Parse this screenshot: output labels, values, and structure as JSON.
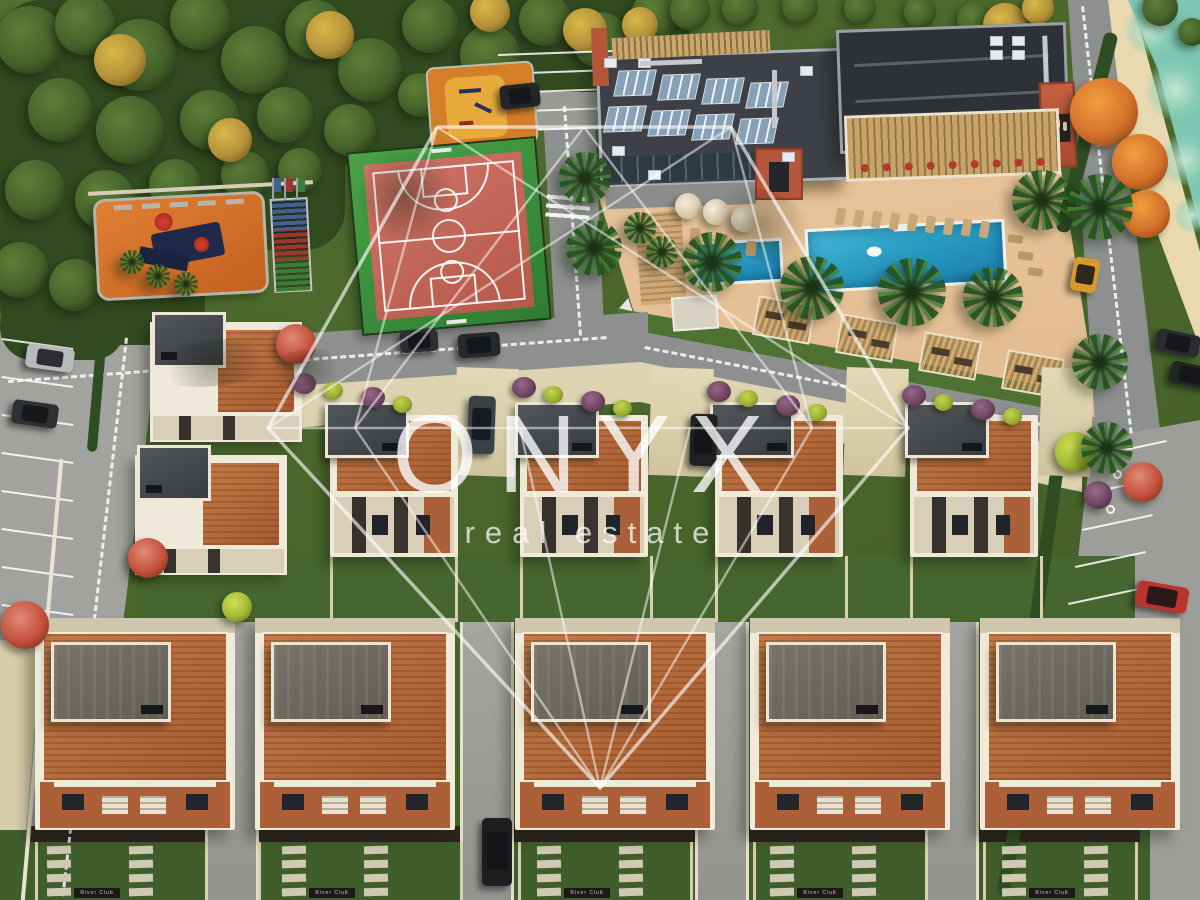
{
  "meta": {
    "title": "Aerial 3D render of ONYX real estate residential villa complex",
    "width": 1200,
    "height": 900
  },
  "watermark": {
    "brand": "ONYX",
    "tagline": "real estate",
    "color": "#ffffff"
  },
  "signs": {
    "villa_plaque": "River Club"
  },
  "palette": {
    "road": "#8e908f",
    "parking": "#a2a29f",
    "deck": "#e4bd92",
    "lawn": "#4e7231",
    "grass": "#4a662c",
    "grassDark": "#3c5a2a",
    "forest": "#314a20",
    "river": "#7cc6b2",
    "cream": "#d9cfad",
    "wallWhite": "#efe9da",
    "brick": "#b0673a",
    "brickLower": "#b86c3c",
    "roofDark": "#3d4046",
    "roofDarker": "#2e3136",
    "roofGrey": "#6e6a60",
    "courtRed": "#c4685c",
    "courtGreen": "#3e9a40",
    "playOrange": "#d06f28",
    "fitOrange": "#d57e28",
    "fitYellow": "#e8a93c",
    "pool": "#2b9fc4",
    "poolDeep": "#1b7fae",
    "pergola": "#c7a365",
    "accentOrange": "#b5553a",
    "solar": "#86a0b8",
    "bleacherBlue": "#44608f",
    "bleacherRed": "#9e3430",
    "bleacherGreen": "#3f7a38"
  },
  "scene": {
    "groundPolys": [
      {
        "name": "amenity-deck",
        "color": "#e4bd92",
        "pts": [
          [
            596,
            188
          ],
          [
            1058,
            150
          ],
          [
            1100,
            418
          ],
          [
            646,
            352
          ]
        ],
        "grad": "linear-gradient(170deg,#ecc9a0,#dcb184)"
      },
      {
        "name": "pool-lawn-band",
        "color": "#4e7231",
        "pts": [
          [
            616,
            308
          ],
          [
            1078,
            392
          ],
          [
            1092,
            440
          ],
          [
            634,
            352
          ]
        ]
      },
      {
        "name": "promenade",
        "color": "#e8d9b0",
        "pts": [
          [
            1090,
            0
          ],
          [
            1132,
            0
          ],
          [
            1200,
            252
          ],
          [
            1200,
            348
          ],
          [
            1106,
            95
          ]
        ]
      },
      {
        "name": "river",
        "color": "#7cc6b2",
        "pts": [
          [
            1128,
            0
          ],
          [
            1200,
            0
          ],
          [
            1200,
            228
          ],
          [
            1158,
            70
          ]
        ]
      },
      {
        "name": "road-left-horizontal",
        "color": "#8e908f",
        "pts": [
          [
            0,
            352
          ],
          [
            648,
            312
          ],
          [
            648,
            368
          ],
          [
            0,
            406
          ]
        ]
      },
      {
        "name": "road-vertical-top",
        "color": "#8e908f",
        "pts": [
          [
            542,
            96
          ],
          [
            594,
            96
          ],
          [
            604,
            330
          ],
          [
            556,
            344
          ]
        ]
      },
      {
        "name": "road-east",
        "color": "#8e908f",
        "pts": [
          [
            612,
            326
          ],
          [
            1098,
            418
          ],
          [
            1098,
            470
          ],
          [
            612,
            372
          ]
        ]
      },
      {
        "name": "road-right-diagonal",
        "color": "#8e908f",
        "pts": [
          [
            1068,
            0
          ],
          [
            1108,
            0
          ],
          [
            1160,
            430
          ],
          [
            1096,
            440
          ]
        ]
      },
      {
        "name": "parking-right-band",
        "color": "#9d9d9a",
        "pts": [
          [
            1092,
            440
          ],
          [
            1200,
            420
          ],
          [
            1200,
            900
          ],
          [
            1008,
            900
          ],
          [
            1068,
            650
          ],
          [
            1080,
            540
          ]
        ]
      },
      {
        "name": "parking-left",
        "color": "#a2a29f",
        "pts": [
          [
            0,
            330
          ],
          [
            160,
            330
          ],
          [
            88,
            900
          ],
          [
            0,
            900
          ]
        ]
      },
      {
        "name": "parking-top",
        "color": "#9a9a97",
        "pts": [
          [
            492,
            46
          ],
          [
            622,
            46
          ],
          [
            628,
            130
          ],
          [
            498,
            130
          ]
        ]
      },
      {
        "name": "sidewalk-bottom-left",
        "color": "#d8cdaa",
        "pts": [
          [
            0,
            640
          ],
          [
            42,
            640
          ],
          [
            20,
            900
          ],
          [
            0,
            900
          ]
        ]
      },
      {
        "name": "apron-upper-villas",
        "color": "#ddd3b1",
        "pts": [
          [
            293,
            386
          ],
          [
            640,
            362
          ],
          [
            1082,
            450
          ],
          [
            1082,
            492
          ],
          [
            640,
            402
          ],
          [
            293,
            428
          ]
        ]
      },
      {
        "name": "midband-grass",
        "color": "#46662f",
        "pts": [
          [
            140,
            556
          ],
          [
            1135,
            556
          ],
          [
            1135,
            622
          ],
          [
            140,
            622
          ]
        ]
      },
      {
        "name": "backyard-band",
        "color": "#3f5e2b",
        "pts": [
          [
            0,
            830
          ],
          [
            1150,
            830
          ],
          [
            1150,
            900
          ],
          [
            0,
            900
          ]
        ]
      },
      {
        "name": "rear-wall-strip",
        "color": "#2b241e",
        "pts": [
          [
            30,
            826
          ],
          [
            1140,
            826
          ],
          [
            1140,
            842
          ],
          [
            30,
            842
          ]
        ]
      }
    ],
    "forestRects": [
      {
        "x": 0,
        "y": 0,
        "w": 690,
        "h": 92
      },
      {
        "x": 0,
        "y": 0,
        "w": 470,
        "h": 165
      },
      {
        "x": 0,
        "y": 60,
        "w": 345,
        "h": 190
      },
      {
        "x": 0,
        "y": 180,
        "w": 205,
        "h": 165
      },
      {
        "x": 0,
        "y": 295,
        "w": 125,
        "h": 65
      }
    ],
    "forestTrees": [
      [
        30,
        40,
        34,
        "g"
      ],
      [
        85,
        25,
        30,
        "g"
      ],
      [
        140,
        55,
        36,
        "g"
      ],
      [
        200,
        20,
        30,
        "g"
      ],
      [
        255,
        60,
        34,
        "g"
      ],
      [
        315,
        30,
        30,
        "g"
      ],
      [
        370,
        70,
        32,
        "g"
      ],
      [
        430,
        25,
        28,
        "g"
      ],
      [
        490,
        55,
        30,
        "g"
      ],
      [
        545,
        20,
        26,
        "g"
      ],
      [
        600,
        40,
        28,
        "g"
      ],
      [
        655,
        15,
        24,
        "g"
      ],
      [
        60,
        110,
        32,
        "g"
      ],
      [
        130,
        130,
        34,
        "g"
      ],
      [
        210,
        120,
        30,
        "g"
      ],
      [
        285,
        115,
        28,
        "g"
      ],
      [
        350,
        130,
        26,
        "g"
      ],
      [
        35,
        190,
        30,
        "g"
      ],
      [
        105,
        200,
        30,
        "g"
      ],
      [
        175,
        185,
        26,
        "g"
      ],
      [
        245,
        175,
        24,
        "g"
      ],
      [
        20,
        270,
        28,
        "g"
      ],
      [
        75,
        285,
        26,
        "g"
      ],
      [
        300,
        170,
        22,
        "g"
      ],
      [
        420,
        95,
        22,
        "g"
      ],
      [
        470,
        110,
        20,
        "g"
      ],
      [
        520,
        90,
        18,
        "g"
      ],
      [
        690,
        10,
        20,
        "g"
      ],
      [
        740,
        8,
        18,
        "g"
      ],
      [
        800,
        6,
        18,
        "g"
      ],
      [
        860,
        8,
        16,
        "g"
      ],
      [
        920,
        12,
        16,
        "g"
      ],
      [
        975,
        20,
        18,
        "g"
      ],
      [
        1160,
        8,
        18,
        "g"
      ],
      [
        1192,
        32,
        14,
        "g"
      ],
      [
        120,
        60,
        26,
        "y"
      ],
      [
        330,
        35,
        24,
        "y"
      ],
      [
        490,
        12,
        20,
        "y"
      ],
      [
        585,
        30,
        22,
        "y"
      ],
      [
        640,
        25,
        18,
        "y"
      ],
      [
        230,
        140,
        22,
        "y"
      ],
      [
        1005,
        25,
        22,
        "y"
      ],
      [
        1038,
        8,
        16,
        "y"
      ]
    ],
    "autumnTrees": [
      [
        1104,
        112,
        34
      ],
      [
        1140,
        162,
        28
      ],
      [
        1146,
        214,
        24
      ]
    ],
    "accentTrees": [
      [
        296,
        344,
        20,
        "red"
      ],
      [
        148,
        558,
        20,
        "red"
      ],
      [
        25,
        625,
        24,
        "red"
      ],
      [
        237,
        607,
        15,
        "lime"
      ],
      [
        1075,
        452,
        20,
        "lime"
      ],
      [
        1098,
        495,
        14,
        "purple"
      ],
      [
        1143,
        482,
        20,
        "red"
      ]
    ],
    "bushes": [
      [
        303,
        383,
        "p"
      ],
      [
        372,
        397,
        "p"
      ],
      [
        523,
        387,
        "p"
      ],
      [
        592,
        401,
        "p"
      ],
      [
        718,
        391,
        "p"
      ],
      [
        787,
        405,
        "p"
      ],
      [
        913,
        395,
        "p"
      ],
      [
        982,
        409,
        "p"
      ],
      [
        335,
        392,
        "l"
      ],
      [
        404,
        406,
        "l"
      ],
      [
        555,
        396,
        "l"
      ],
      [
        624,
        410,
        "l"
      ],
      [
        750,
        400,
        "l"
      ],
      [
        819,
        414,
        "l"
      ],
      [
        945,
        404,
        "l"
      ],
      [
        1014,
        418,
        "l"
      ]
    ],
    "palms": [
      [
        585,
        178,
        26
      ],
      [
        594,
        248,
        28
      ],
      [
        712,
        262,
        30
      ],
      [
        812,
        288,
        32
      ],
      [
        912,
        292,
        34
      ],
      [
        993,
        297,
        30
      ],
      [
        1042,
        200,
        30
      ],
      [
        640,
        228,
        16
      ],
      [
        662,
        252,
        16
      ],
      [
        1100,
        207,
        33
      ],
      [
        1100,
        362,
        28
      ],
      [
        1107,
        448,
        26
      ],
      [
        132,
        262,
        12
      ],
      [
        158,
        276,
        12
      ],
      [
        186,
        284,
        12
      ]
    ],
    "cars": [
      {
        "n": "suv-road-1",
        "x": 400,
        "y": 330,
        "w": 38,
        "h": 22,
        "c": "#2b2d30",
        "r": -4
      },
      {
        "n": "suv-road-2",
        "x": 458,
        "y": 333,
        "w": 42,
        "h": 24,
        "c": "#26282b",
        "r": -4
      },
      {
        "n": "car-driveway-upper-1",
        "x": 468,
        "y": 396,
        "w": 27,
        "h": 58,
        "c": "#3a4047",
        "r": 2
      },
      {
        "n": "car-driveway-upper-2",
        "x": 690,
        "y": 414,
        "w": 27,
        "h": 52,
        "c": "#1e2022",
        "r": 2
      },
      {
        "n": "car-parking-top",
        "x": 500,
        "y": 84,
        "w": 40,
        "h": 24,
        "c": "#232528",
        "r": -6
      },
      {
        "n": "car-parking-left-silver",
        "x": 26,
        "y": 346,
        "w": 48,
        "h": 24,
        "c": "#b8b9ba",
        "r": 8
      },
      {
        "n": "car-parking-left-dark",
        "x": 12,
        "y": 402,
        "w": 46,
        "h": 24,
        "c": "#2e3134",
        "r": 8
      },
      {
        "n": "taxi-yellow",
        "x": 1072,
        "y": 258,
        "w": 26,
        "h": 34,
        "c": "#d89a2b",
        "r": 10
      },
      {
        "n": "car-red-parked",
        "x": 1136,
        "y": 584,
        "w": 52,
        "h": 26,
        "c": "#b8342c",
        "r": 10
      },
      {
        "n": "car-right-parked-1",
        "x": 1156,
        "y": 332,
        "w": 44,
        "h": 22,
        "c": "#2a2c2f",
        "r": 12
      },
      {
        "n": "car-right-parked-2",
        "x": 1170,
        "y": 364,
        "w": 40,
        "h": 22,
        "c": "#222426",
        "r": 12
      },
      {
        "n": "car-driveway-bottom",
        "x": 482,
        "y": 818,
        "w": 30,
        "h": 68,
        "c": "#1c1e20",
        "r": 0
      }
    ],
    "umbrellas": [
      [
        688,
        206
      ],
      [
        716,
        212
      ],
      [
        744,
        219
      ]
    ],
    "loungersRow": {
      "x0": 836,
      "y0": 208,
      "dx": 18,
      "dy": 1.6,
      "count": 9
    },
    "loungersLawn": [
      [
        1008,
        235
      ],
      [
        1018,
        252
      ],
      [
        1028,
        268
      ]
    ],
    "loungersDeck": [
      [
        690,
        228
      ],
      [
        718,
        234
      ],
      [
        746,
        241
      ]
    ],
    "cabanas": [
      [
        755,
        300
      ],
      [
        838,
        318
      ],
      [
        921,
        336
      ],
      [
        1004,
        354
      ]
    ],
    "pools": {
      "kids": {
        "x": 695,
        "y": 240,
        "w": 88,
        "h": 44,
        "rot": -3
      },
      "main": {
        "x": 806,
        "y": 224,
        "w": 200,
        "h": 64,
        "rot": -3
      }
    },
    "clubhouse": {
      "left": {
        "x": 598,
        "y": 52,
        "w": 250,
        "h": 132,
        "rot": -2
      },
      "right": {
        "x": 838,
        "y": 26,
        "w": 230,
        "h": 124,
        "rot": -2
      },
      "towerX": 1040,
      "towerY": 82,
      "entrance": {
        "x": 755,
        "y": 148,
        "w": 48,
        "h": 52
      },
      "pergola": {
        "x": 845,
        "y": 112,
        "w": 215,
        "h": 66,
        "rot": -2
      },
      "fence": {
        "x": 612,
        "y": 34,
        "w": 158,
        "h": 22,
        "rot": -3
      },
      "solarRows": [
        [
          616,
          70
        ],
        [
          660,
          74
        ],
        [
          704,
          78
        ],
        [
          748,
          82
        ],
        [
          606,
          106
        ],
        [
          650,
          110
        ],
        [
          694,
          114
        ],
        [
          738,
          118
        ]
      ]
    },
    "basketball": {
      "x": 356,
      "y": 146,
      "w": 186,
      "h": 180,
      "rot": -5
    },
    "fitness": {
      "x": 428,
      "y": 64,
      "w": 108,
      "h": 82,
      "rot": -4
    },
    "playground": {
      "x": 95,
      "y": 195,
      "w": 172,
      "h": 102,
      "rot": -3
    },
    "bleachers": {
      "x": 272,
      "y": 198,
      "w": 38,
      "h": 94,
      "rot": -3
    },
    "villas": {
      "upperXs": [
        330,
        520,
        715,
        910
      ],
      "upperTop": 415,
      "lowerXs": [
        35,
        255,
        515,
        750,
        980
      ],
      "lowerTop": 618,
      "left": [
        [
          150,
          322
        ],
        [
          135,
          455
        ]
      ]
    },
    "drivewaysUpper": [
      [
        455,
        62
      ],
      [
        650,
        62
      ],
      [
        845,
        62
      ],
      [
        1040,
        52
      ]
    ],
    "drivewaysLower": [
      205,
      460,
      695,
      925
    ],
    "plaques": {
      "xs": [
        95,
        330,
        585,
        818,
        1050
      ],
      "y": 888
    },
    "dashes": [
      {
        "x": 8,
        "y": 380,
        "len": 600,
        "rot": -4.2
      },
      {
        "x": 645,
        "y": 346,
        "len": 450,
        "rot": 11
      },
      {
        "x": 566,
        "y": 106,
        "len": 230,
        "rot": 86
      },
      {
        "x": 1084,
        "y": 6,
        "len": 430,
        "rot": 83.5
      },
      {
        "x": 128,
        "y": 338,
        "len": 562,
        "rot": 96.5
      }
    ],
    "stalls": {
      "left": {
        "x0": 2,
        "y0": 338,
        "dy": 38,
        "count": 8,
        "len": 72,
        "rot": 8
      },
      "top": {
        "x0": 498,
        "y0": 54,
        "dy": 19,
        "count": 5,
        "len": 118,
        "rot": -2
      },
      "right": {
        "x0": 1096,
        "y0": 455,
        "dx": -7,
        "dy": 37,
        "count": 6,
        "len": 72,
        "rot": -12
      }
    },
    "zebra": {
      "x": 546,
      "y": 196,
      "w": 44,
      "h": 24,
      "rot": 4
    },
    "yield": {
      "x": 620,
      "y": 298
    }
  },
  "gem": {
    "outer": "437,127 731,127 908,428 600,788 268,428 437,127",
    "lines": [
      "268,428 908,428",
      "437,127 355,428",
      "355,428 584,127",
      "584,127 812,428",
      "812,428 731,127",
      "437,127 908,428",
      "731,127 268,428",
      "355,428 600,788",
      "812,428 600,788",
      "520,428 600,788",
      "690,428 600,788"
    ]
  }
}
